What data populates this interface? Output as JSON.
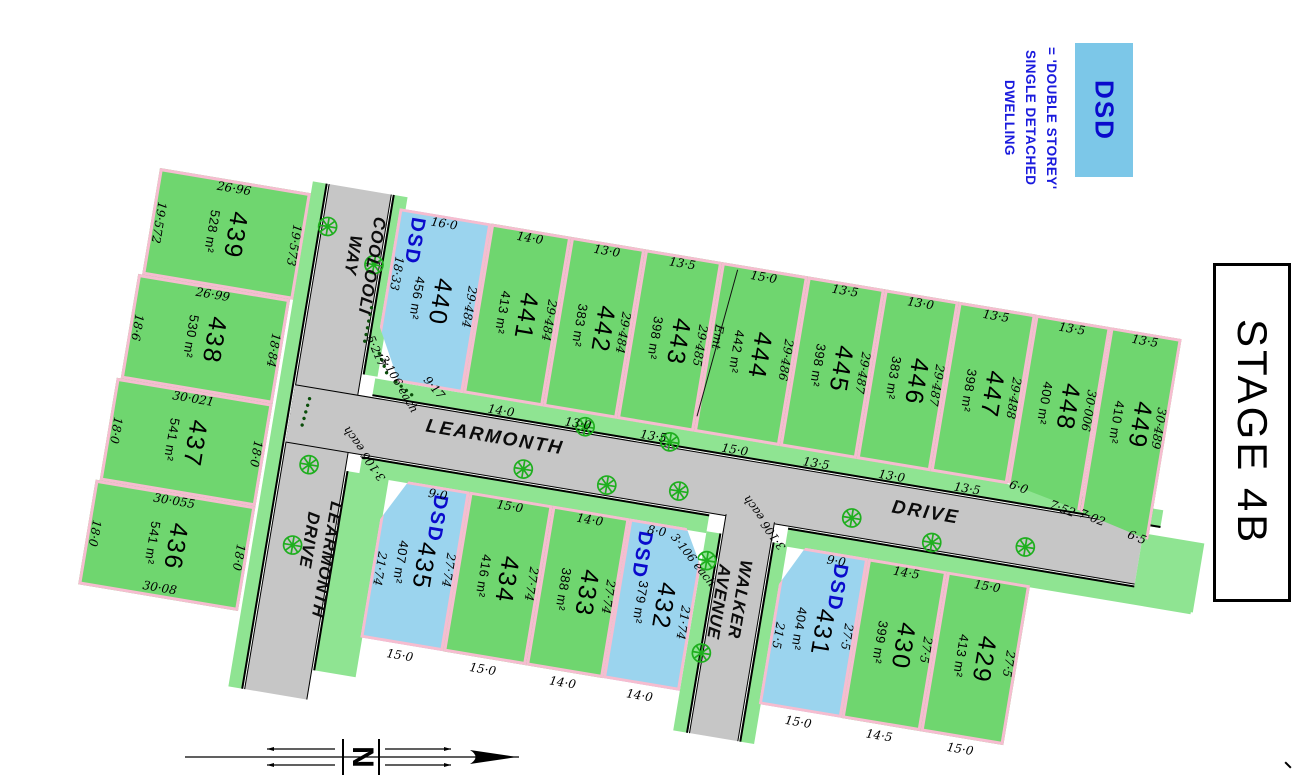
{
  "stage": {
    "label": "STAGE 4B"
  },
  "legend": {
    "dsd": "DSD",
    "lines": [
      "= 'DOUBLE STOREY'",
      "SINGLE DETACHED",
      "DWELLING"
    ]
  },
  "north": {
    "label": "N"
  },
  "dsd_tag": "DSD",
  "streets": {
    "coolooli": [
      "COOLOOLI",
      "WAY"
    ],
    "learmonth_h": [
      "LEARMONTH",
      "DRIVE"
    ],
    "learmonth_v": [
      "LEARMONTH",
      "DRIVE"
    ],
    "walker": [
      "WALKER",
      "AVENUE"
    ]
  },
  "colors": {
    "lot_green": "#6fd66f",
    "dsd_lot_blue": "#9bd4ee",
    "road_gray": "#c6c6c6",
    "verge_green": "#8fe492",
    "boundary_pink": "#f6bdd0",
    "legend_box_blue": "#7cc7e8",
    "dsd_text_blue": "#0a0acc",
    "tree_green": "#1faf1f"
  },
  "lots": {
    "439": {
      "num": "439",
      "area": "528 m²",
      "top": "26·96",
      "left": "19·572",
      "right": "19·573"
    },
    "438": {
      "num": "438",
      "area": "530 m²",
      "top": "26·99",
      "left": "18·6",
      "right": "18·84"
    },
    "437": {
      "num": "437",
      "area": "541 m²",
      "top": "30·021",
      "left": "18·0",
      "right": "18·0"
    },
    "436": {
      "num": "436",
      "area": "541 m²",
      "top": "30·055",
      "left": "18·0",
      "right": "18·0",
      "bottom": "30·08"
    },
    "440": {
      "num": "440",
      "area": "456 m²",
      "dsd": true,
      "top": "16·0",
      "left": "18·33",
      "right": "29·484",
      "splay1": "5·217",
      "splay2": "3·106 each",
      "splay3": "9·17"
    },
    "441": {
      "num": "441",
      "area": "413 m²",
      "top": "14·0",
      "right": "29·484",
      "bottom": "14·0"
    },
    "442": {
      "num": "442",
      "area": "383 m²",
      "top": "13·0",
      "right": "29·484",
      "bottom": "13·0"
    },
    "443": {
      "num": "443",
      "area": "398 m²",
      "top": "13·5",
      "right": "29·485",
      "bottom": "13·5"
    },
    "444": {
      "num": "444",
      "area": "442 m²",
      "top": "15·0",
      "right": "29·486",
      "bottom": "15·0",
      "easement": "Emt"
    },
    "445": {
      "num": "445",
      "area": "398 m²",
      "top": "13·5",
      "right": "29·487",
      "bottom": "13·5"
    },
    "446": {
      "num": "446",
      "area": "383 m²",
      "top": "13·0",
      "right": "29·487",
      "bottom": "13·0"
    },
    "447": {
      "num": "447",
      "area": "398 m²",
      "top": "13·5",
      "right": "29·488",
      "bottom": "13·5"
    },
    "448": {
      "num": "448",
      "area": "400 m²",
      "top": "13·5",
      "right": "30·006",
      "bottom_left": "6·0",
      "bottom_right": "7·52"
    },
    "449": {
      "num": "449",
      "area": "410 m²",
      "top": "13·5",
      "right": "30·489",
      "bottom_left": "7·02",
      "bottom_right": "6·5"
    },
    "435": {
      "num": "435",
      "area": "407 m²",
      "dsd": true,
      "top": "9·0",
      "left": "21·74",
      "right": "27·74",
      "bottom": "15·0",
      "splay": "3·106 each"
    },
    "434": {
      "num": "434",
      "area": "416 m²",
      "top": "15·0",
      "right": "27·74",
      "bottom": "15·0"
    },
    "433": {
      "num": "433",
      "area": "388 m²",
      "top": "14·0",
      "right": "27·74",
      "bottom": "14·0"
    },
    "432": {
      "num": "432",
      "area": "379 m²",
      "dsd": true,
      "top": "8·0",
      "right": "21·74",
      "bottom": "14·0",
      "splay": "3·106 each"
    },
    "431": {
      "num": "431",
      "area": "404 m²",
      "dsd": true,
      "top": "9·0",
      "left": "21·5",
      "right": "27·5",
      "bottom": "15·0",
      "splay": "3·106 each"
    },
    "430": {
      "num": "430",
      "area": "399 m²",
      "top": "14·5",
      "right": "27·5",
      "bottom": "14·5"
    },
    "429": {
      "num": "429",
      "area": "413 m²",
      "top": "15·0",
      "right": "27·5",
      "bottom": "15·0"
    }
  }
}
